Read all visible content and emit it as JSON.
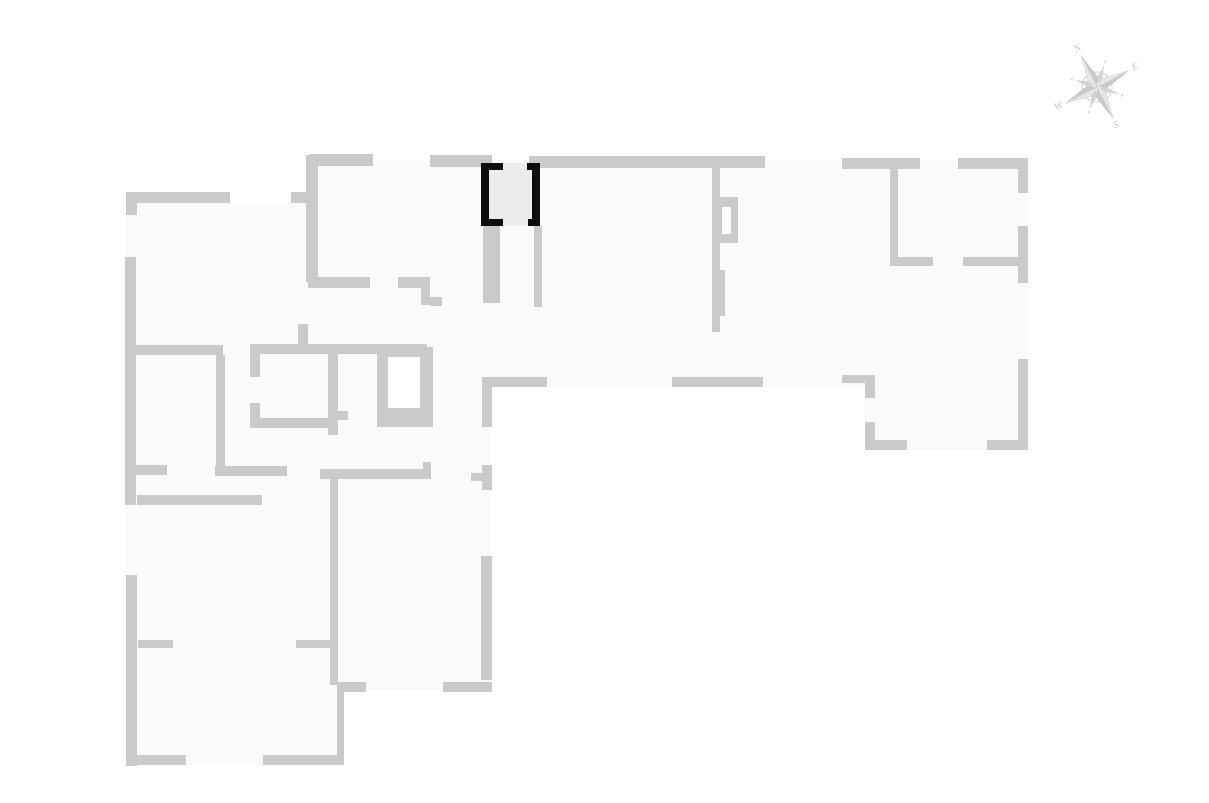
{
  "canvas": {
    "width": 1209,
    "height": 803,
    "background": "#ffffff"
  },
  "colors": {
    "wall": "#cacaca",
    "floor": "#fafafa",
    "hole": "#ffffff",
    "unit_fill": "#ececec",
    "unit_wall": "#0d0d0d",
    "compass_main": "#d3d3d3",
    "compass_dark": "#c9c9c9",
    "compass_light": "#e7e7e7",
    "compass_ring": "#d6d6d6",
    "compass_text": "#c6c6c6"
  },
  "floor_polygons": [
    [
      [
        318,
        160
      ],
      [
        1028,
        160
      ],
      [
        1028,
        450
      ],
      [
        865,
        450
      ],
      [
        865,
        387
      ],
      [
        318,
        387
      ]
    ],
    [
      [
        126,
        192
      ],
      [
        230,
        192
      ],
      [
        230,
        203
      ],
      [
        306,
        203
      ],
      [
        306,
        192
      ],
      [
        318,
        192
      ],
      [
        318,
        345
      ],
      [
        126,
        345
      ]
    ],
    [
      [
        126,
        345
      ],
      [
        490,
        345
      ],
      [
        490,
        690
      ],
      [
        344,
        690
      ],
      [
        344,
        765
      ],
      [
        126,
        765
      ]
    ]
  ],
  "walls": [
    [
      310,
      154,
      63,
      12
    ],
    [
      430,
      155,
      62,
      12
    ],
    [
      529,
      156,
      236,
      12
    ],
    [
      842,
      158,
      78,
      11
    ],
    [
      958,
      158,
      70,
      11
    ],
    [
      1018,
      158,
      10,
      35
    ],
    [
      126,
      192,
      104,
      11
    ],
    [
      126,
      203,
      11,
      12
    ],
    [
      291,
      192,
      17,
      11
    ],
    [
      306,
      155,
      12,
      127
    ],
    [
      308,
      277,
      62,
      11
    ],
    [
      398,
      277,
      32,
      11
    ],
    [
      421,
      288,
      9,
      17
    ],
    [
      430,
      297,
      12,
      9
    ],
    [
      125,
      257,
      11,
      248
    ],
    [
      126,
      575,
      11,
      191
    ],
    [
      136,
      345,
      87,
      10
    ],
    [
      216,
      355,
      9,
      118
    ],
    [
      136,
      465,
      31,
      10
    ],
    [
      215,
      466,
      72,
      10
    ],
    [
      137,
      495,
      125,
      10
    ],
    [
      250,
      344,
      177,
      10
    ],
    [
      250,
      354,
      10,
      23
    ],
    [
      250,
      403,
      10,
      25
    ],
    [
      259,
      418,
      71,
      10
    ],
    [
      328,
      350,
      10,
      85
    ],
    [
      338,
      411,
      10,
      9
    ],
    [
      298,
      324,
      10,
      20
    ],
    [
      483,
      226,
      17,
      77
    ],
    [
      534,
      226,
      8,
      81
    ],
    [
      712,
      168,
      8,
      164
    ],
    [
      715,
      270,
      10,
      46
    ],
    [
      484,
      377,
      63,
      10
    ],
    [
      672,
      377,
      91,
      10
    ],
    [
      482,
      377,
      10,
      50
    ],
    [
      482,
      465,
      10,
      25
    ],
    [
      471,
      473,
      12,
      8
    ],
    [
      890,
      168,
      8,
      90
    ],
    [
      890,
      257,
      43,
      9
    ],
    [
      963,
      257,
      55,
      9
    ],
    [
      1018,
      226,
      10,
      57
    ],
    [
      1018,
      359,
      10,
      91
    ],
    [
      987,
      440,
      41,
      10
    ],
    [
      842,
      375,
      33,
      8
    ],
    [
      865,
      383,
      10,
      15
    ],
    [
      865,
      422,
      10,
      28
    ],
    [
      865,
      440,
      42,
      10
    ],
    [
      320,
      469,
      111,
      10
    ],
    [
      423,
      462,
      8,
      7
    ],
    [
      481,
      556,
      11,
      124
    ],
    [
      443,
      682,
      49,
      10
    ],
    [
      337,
      682,
      29,
      10
    ],
    [
      330,
      473,
      8,
      212
    ],
    [
      337,
      685,
      7,
      80
    ],
    [
      138,
      640,
      35,
      8
    ],
    [
      296,
      640,
      37,
      8
    ],
    [
      126,
      755,
      60,
      10
    ],
    [
      263,
      755,
      80,
      10
    ]
  ],
  "shaft": {
    "frame": [
      377,
      347,
      56,
      80
    ],
    "hole": [
      388,
      357,
      32,
      51
    ]
  },
  "door_frame": {
    "frame": [
      716,
      197,
      22,
      46
    ],
    "hole": [
      722,
      207,
      9,
      27
    ]
  },
  "highlighted_unit": {
    "fill_rect": [
      481,
      163,
      59,
      63
    ],
    "wall_rects": [
      [
        481,
        163,
        8,
        63
      ],
      [
        532,
        163,
        8,
        63
      ],
      [
        481,
        163,
        22,
        7
      ],
      [
        527,
        163,
        13,
        7
      ],
      [
        481,
        219,
        22,
        7
      ],
      [
        528,
        219,
        12,
        7
      ]
    ]
  },
  "compass": {
    "cx": 1097,
    "cy": 87,
    "rotation_deg": -27,
    "ring_outer_r": 15,
    "ring_inner_r": 11,
    "main_point_len": 36,
    "main_point_half_w": 5.5,
    "diag_point_len": 23,
    "label_radius": 43,
    "labels": {
      "n": "N",
      "e": "E",
      "s": "S",
      "w": "W"
    }
  }
}
